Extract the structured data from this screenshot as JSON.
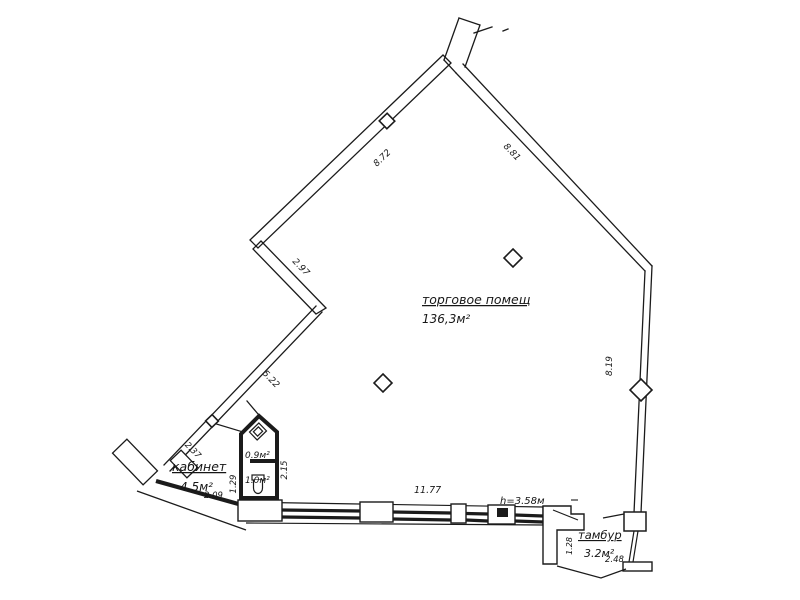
{
  "drawing": {
    "type": "floor-plan",
    "ink_color": "#1b1b1b",
    "paper_color": "#ffffff"
  },
  "rooms": {
    "main_hall": {
      "name": "торговое помещ",
      "area": "136,3м²"
    },
    "office": {
      "name": "кабинет",
      "area": "4.5м²"
    },
    "vestibule": {
      "name": "тамбур",
      "area": "3.2м²"
    },
    "wc_small": {
      "area": "0.9м²"
    },
    "wc": {
      "area": "1.0м²"
    }
  },
  "dimensions": {
    "wall_top_left": "8.72",
    "wall_top_right": "8.81",
    "wall_right": "8.19",
    "zigzag_upper": "2.97",
    "zigzag_lower": "5.22",
    "office_diagonal": "2.37",
    "office_width": "2.09",
    "office_inner": "1.29",
    "wc_side": "2.15",
    "bottom_wall": "11.77",
    "ceiling_height": "h=3.58м",
    "vestibule_depth": "1.28",
    "vestibule_width": "2.48"
  }
}
